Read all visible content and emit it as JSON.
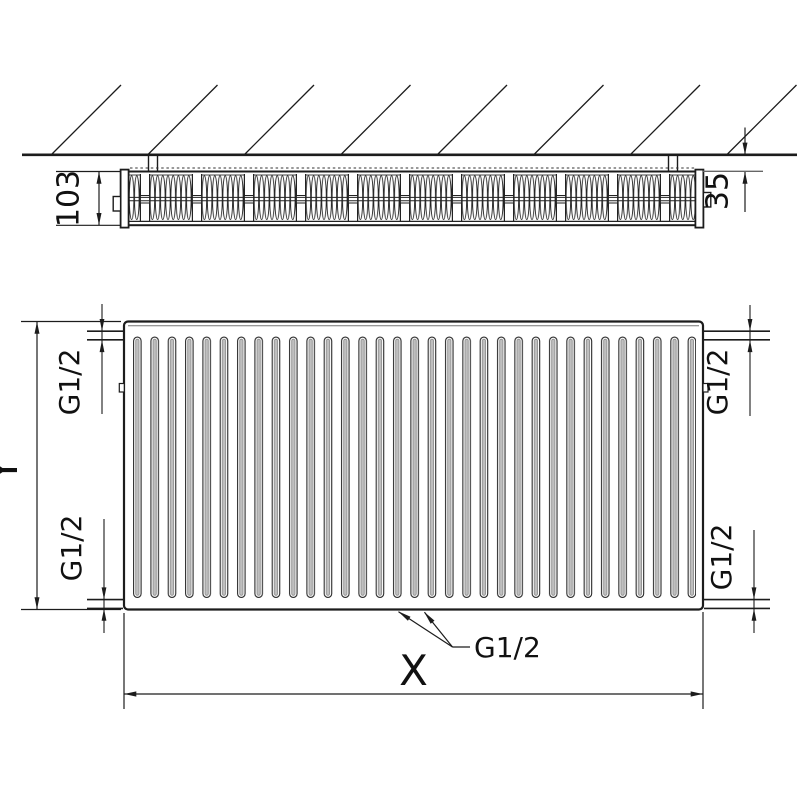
{
  "drawing": {
    "description": "Technical dimension drawing of a panel radiator: top cross-section view at wall and front view",
    "top_view": {
      "depth_label": "103",
      "wall_gap_label": "35"
    },
    "front_view": {
      "height_label": "Y",
      "width_label": "X",
      "connection_label": "G1/2"
    }
  },
  "colors": {
    "line": "#1c1c1c",
    "secondary_line": "#666666",
    "text": "#111111",
    "fin_fill": "#bfbfbf",
    "background": "#ffffff"
  }
}
